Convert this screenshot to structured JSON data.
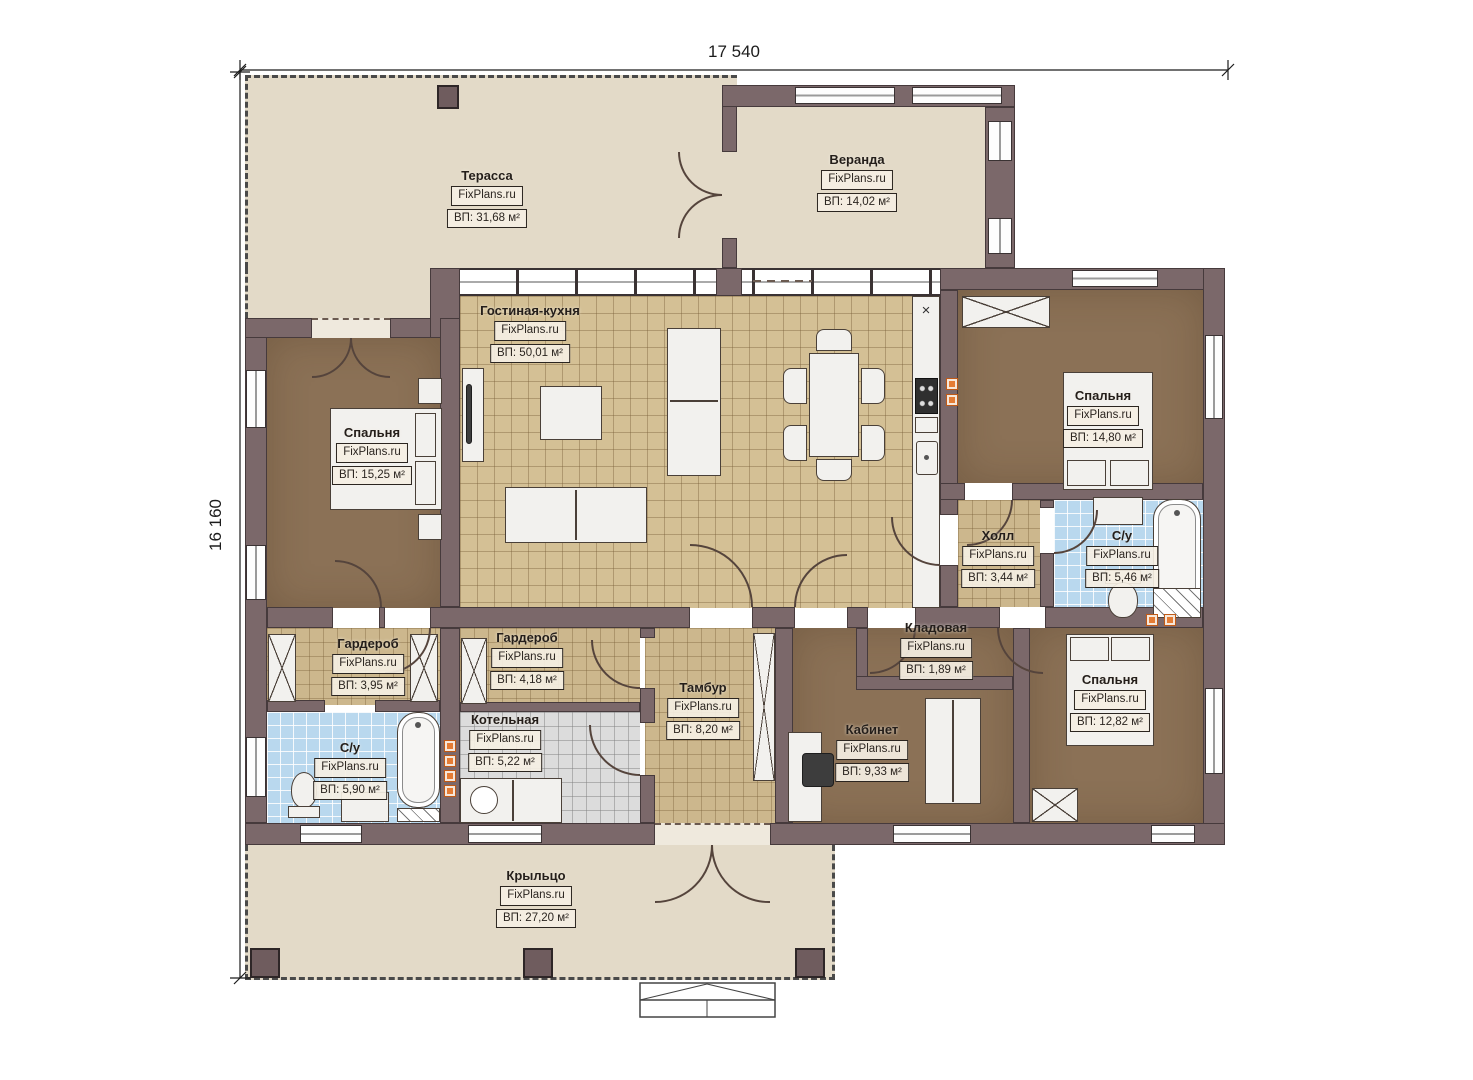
{
  "plan": {
    "brand": "FixPlans.ru",
    "dimensions": {
      "width_label": "17 540",
      "height_label": "16 160"
    },
    "colors": {
      "wall": "#7b686a",
      "deck": "#e3dac8",
      "tile": "#d4c095",
      "bath_tile": "#b9d8ee",
      "room_brown": "#8b7156",
      "accent_orange": "#e47c35"
    },
    "rooms": [
      {
        "id": "terrace",
        "name": "Терасса",
        "brand": "FixPlans.ru",
        "area": "ВП: 31,68 м²"
      },
      {
        "id": "veranda",
        "name": "Веранда",
        "brand": "FixPlans.ru",
        "area": "ВП: 14,02 м²"
      },
      {
        "id": "living-kitchen",
        "name": "Гостиная-кухня",
        "brand": "FixPlans.ru",
        "area": "ВП: 50,01 м²"
      },
      {
        "id": "bedroom-left",
        "name": "Спальня",
        "brand": "FixPlans.ru",
        "area": "ВП: 15,25 м²"
      },
      {
        "id": "bedroom-right-top",
        "name": "Спальня",
        "brand": "FixPlans.ru",
        "area": "ВП: 14,80 м²"
      },
      {
        "id": "hall",
        "name": "Холл",
        "brand": "FixPlans.ru",
        "area": "ВП: 3,44 м²"
      },
      {
        "id": "bathroom-right",
        "name": "С/у",
        "brand": "FixPlans.ru",
        "area": "ВП: 5,46 м²"
      },
      {
        "id": "wardrobe-left",
        "name": "Гардероб",
        "brand": "FixPlans.ru",
        "area": "ВП: 3,95 м²"
      },
      {
        "id": "wardrobe-mid",
        "name": "Гардероб",
        "brand": "FixPlans.ru",
        "area": "ВП: 4,18 м²"
      },
      {
        "id": "bathroom-left",
        "name": "С/у",
        "brand": "FixPlans.ru",
        "area": "ВП: 5,90 м²"
      },
      {
        "id": "boiler-room",
        "name": "Котельная",
        "brand": "FixPlans.ru",
        "area": "ВП: 5,22 м²"
      },
      {
        "id": "vestibule",
        "name": "Тамбур",
        "brand": "FixPlans.ru",
        "area": "ВП: 8,20 м²"
      },
      {
        "id": "storage",
        "name": "Кладовая",
        "brand": "FixPlans.ru",
        "area": "ВП: 1,89 м²"
      },
      {
        "id": "office",
        "name": "Кабинет",
        "brand": "FixPlans.ru",
        "area": "ВП: 9,33 м²"
      },
      {
        "id": "bedroom-right-bottom",
        "name": "Спальня",
        "brand": "FixPlans.ru",
        "area": "ВП: 12,82 м²"
      },
      {
        "id": "porch",
        "name": "Крыльцо",
        "brand": "FixPlans.ru",
        "area": "ВП: 27,20 м²"
      }
    ]
  }
}
